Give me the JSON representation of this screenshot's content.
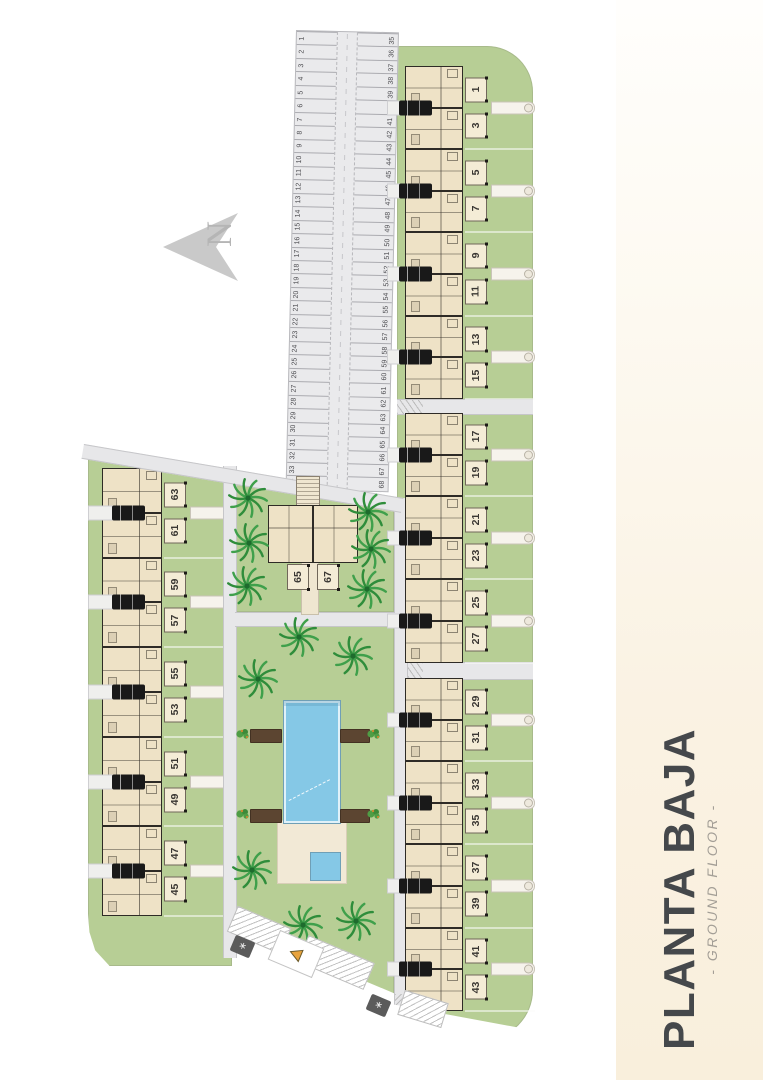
{
  "title_panel": {
    "title": "PLANTA BAJA",
    "subtitle": "- GROUND FLOOR -"
  },
  "north_indicator": {
    "label": "N"
  },
  "site_plan": {
    "parking": {
      "row_outer": [
        "1",
        "2",
        "3",
        "4",
        "5",
        "6",
        "7",
        "8",
        "9",
        "10",
        "11",
        "12",
        "13",
        "14",
        "15",
        "16",
        "17",
        "18",
        "19",
        "20",
        "21",
        "22",
        "23",
        "24",
        "25",
        "26",
        "27",
        "28",
        "29",
        "30",
        "31",
        "32",
        "33",
        "34"
      ],
      "row_inner": [
        "35",
        "36",
        "37",
        "38",
        "39",
        "40",
        "41",
        "42",
        "43",
        "44",
        "45",
        "46",
        "47",
        "48",
        "49",
        "50",
        "51",
        "52",
        "53",
        "54",
        "55",
        "56",
        "57",
        "58",
        "59",
        "60",
        "61",
        "62",
        "63",
        "64",
        "65",
        "66",
        "67",
        "68"
      ]
    },
    "right_band_blocks": [
      {
        "pairs": [
          [
            "1",
            "3"
          ],
          [
            "5",
            "7"
          ],
          [
            "9",
            "11"
          ],
          [
            "13",
            "15"
          ]
        ]
      },
      {
        "pairs": [
          [
            "17",
            "19"
          ],
          [
            "21",
            "23"
          ],
          [
            "25",
            "27"
          ]
        ]
      },
      {
        "pairs": [
          [
            "29",
            "31"
          ],
          [
            "33",
            "35"
          ],
          [
            "37",
            "39"
          ],
          [
            "41",
            "43"
          ]
        ]
      }
    ],
    "left_band": {
      "pairs": [
        [
          "63",
          "61"
        ],
        [
          "59",
          "57"
        ],
        [
          "55",
          "53"
        ],
        [
          "51",
          "49"
        ],
        [
          "47",
          "45"
        ]
      ]
    },
    "center_building": {
      "units": [
        "65",
        "67"
      ]
    },
    "colors": {
      "grass": "#b7ce95",
      "road": "#e7e7e9",
      "house_fill": "#eee2c6",
      "house_wall": "#2e2b26",
      "pool": "#85c8e6",
      "deck": "#f2e9d6",
      "pergola": "#5c4531",
      "panel_cream": "#f9efdc",
      "title_text": "#45484b",
      "palm": "#2f8d3b",
      "warning": "#e8a33d"
    }
  }
}
